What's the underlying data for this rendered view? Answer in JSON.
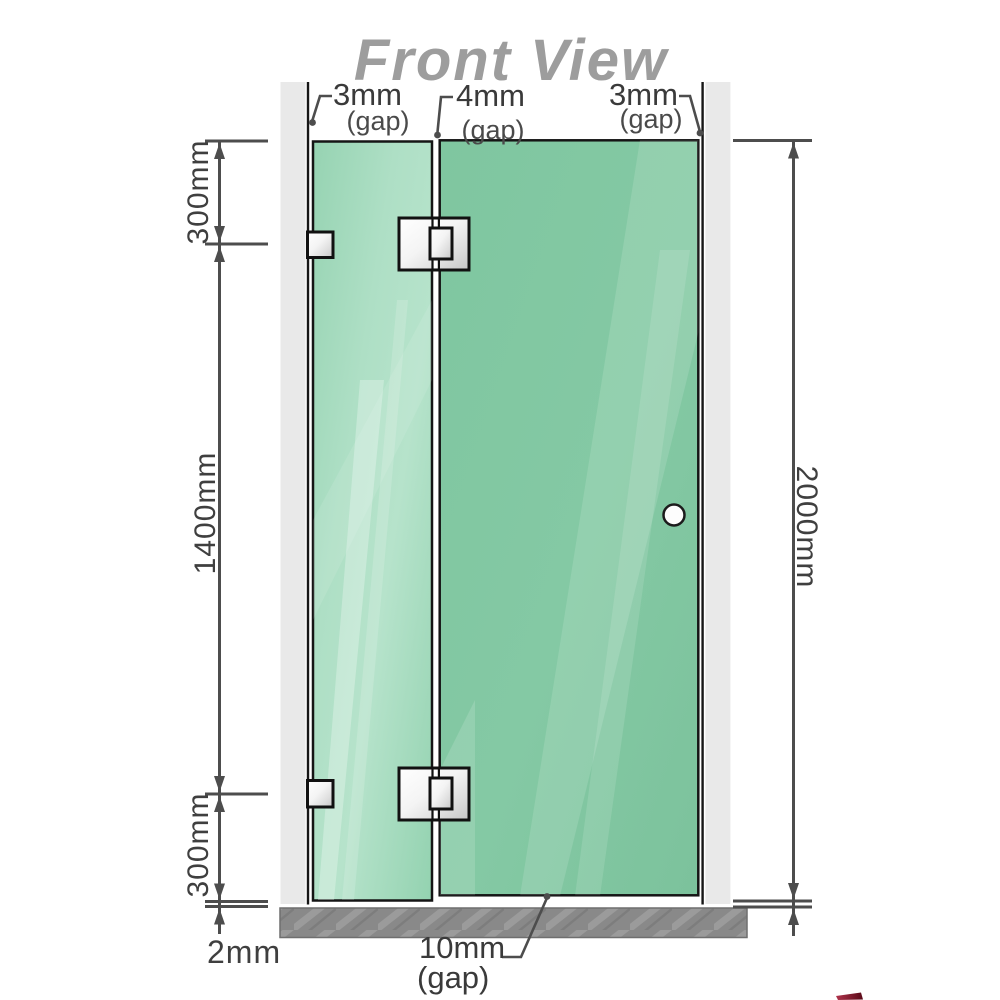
{
  "title": "Front View",
  "colors": {
    "glass_fixed": "#a5dabd",
    "glass_door": "#80c6a0",
    "wall": "#e9e9e9",
    "floor": "#898989",
    "outline": "#161616",
    "dimension": "#4d4d4d",
    "title": "#9d9d9d",
    "metal_highlight": "#ffffff",
    "metal_shadow": "#c6c6c6",
    "logo_red": "#8c0f2a"
  },
  "top_gaps": {
    "left": {
      "value": "3mm",
      "label": "(gap)"
    },
    "middle": {
      "value": "4mm",
      "label": "(gap)"
    },
    "right": {
      "value": "3mm",
      "label": "(gap)"
    }
  },
  "bottom_gap": {
    "value": "10mm",
    "label": "(gap)"
  },
  "dimensions": {
    "left_top": "300mm",
    "left_middle": "1400mm",
    "left_bottom": "300mm",
    "floor_gap": "2mm",
    "right_total": "2000mm"
  }
}
